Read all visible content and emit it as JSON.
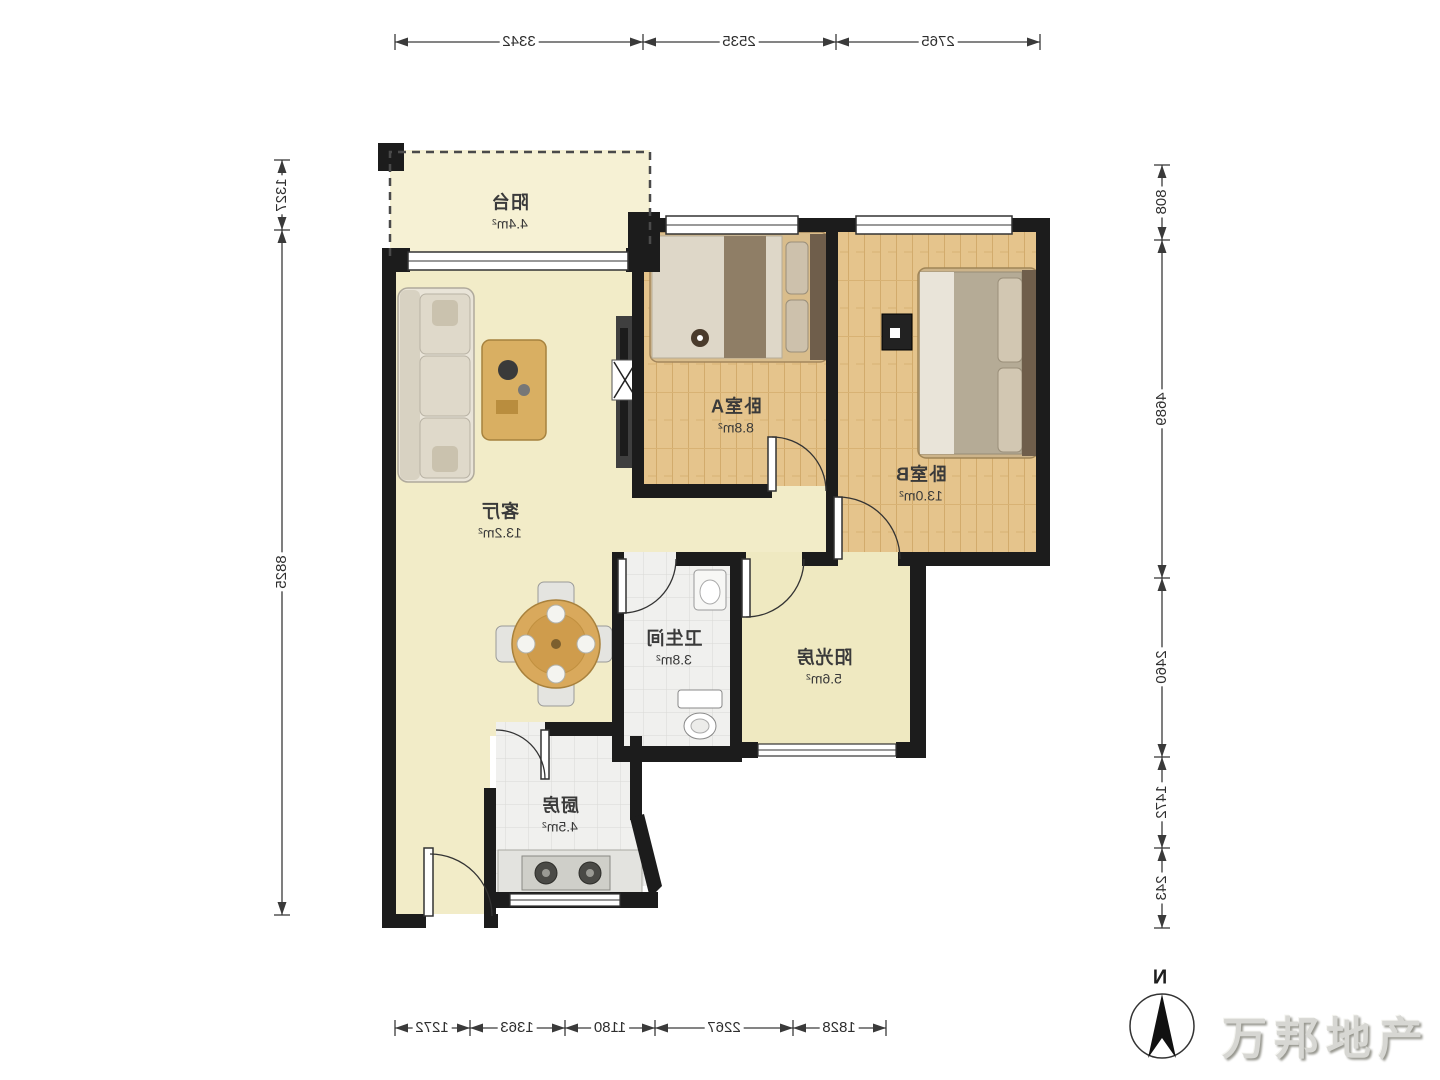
{
  "rooms": {
    "balcony": {
      "name": "阳台",
      "area": "4.4m²"
    },
    "bedroom_a": {
      "name": "卧室A",
      "area": "8.8m²"
    },
    "bedroom_b": {
      "name": "卧室B",
      "area": "13.0m²"
    },
    "living": {
      "name": "客厅",
      "area": "13.2m²"
    },
    "bathroom": {
      "name": "卫生间",
      "area": "3.8m²"
    },
    "sunroom": {
      "name": "阳光房",
      "area": "5.6m²"
    },
    "kitchen": {
      "name": "厨房",
      "area": "4.5m²"
    }
  },
  "dims": {
    "top": [
      "3342",
      "2535",
      "2765"
    ],
    "left": [
      "1327",
      "8825"
    ],
    "right": [
      "808",
      "4689",
      "2460",
      "1472",
      "243"
    ],
    "bottom": [
      "1272",
      "1363",
      "1180",
      "2267",
      "1828"
    ]
  },
  "compass": {
    "label": "N"
  },
  "watermark": {
    "text": "万邦地产"
  },
  "colors": {
    "wall": "#1c1c1c",
    "floor_cream": "#f2ecc8",
    "floor_wood": "#e5c48c",
    "floor_tile": "#f0f0ee",
    "dim_line": "#3a3a3a"
  }
}
